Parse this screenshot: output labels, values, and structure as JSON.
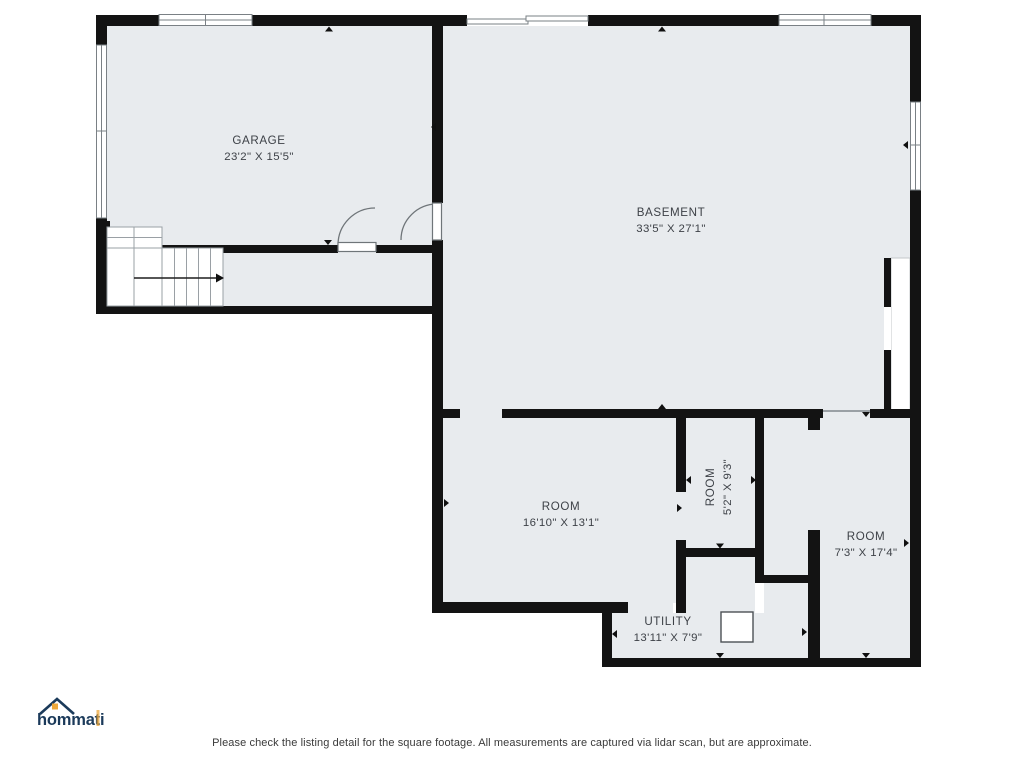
{
  "colors": {
    "wall": "#131313",
    "floor": "#e8ebee",
    "room_text": "#3d4147",
    "logo_navy": "#1b3a5a",
    "logo_orange": "#eea83b"
  },
  "rooms": {
    "garage": {
      "name": "GARAGE",
      "dims": "23'2\" X 15'5\""
    },
    "basement": {
      "name": "BASEMENT",
      "dims": "33'5\" X 27'1\""
    },
    "room_left": {
      "name": "ROOM",
      "dims": "16'10\" X 13'1\""
    },
    "room_small": {
      "name": "ROOM",
      "dims": "5'2\" X 9'3\""
    },
    "room_right": {
      "name": "ROOM",
      "dims": "7'3\" X 17'4\""
    },
    "utility": {
      "name": "UTILITY",
      "dims": "13'11\" X 7'9\""
    }
  },
  "footer": {
    "disclaimer": "Please check the listing detail for the square footage. All measurements are captured via lidar scan, but are approximate."
  },
  "logo": {
    "text": "hommati"
  }
}
